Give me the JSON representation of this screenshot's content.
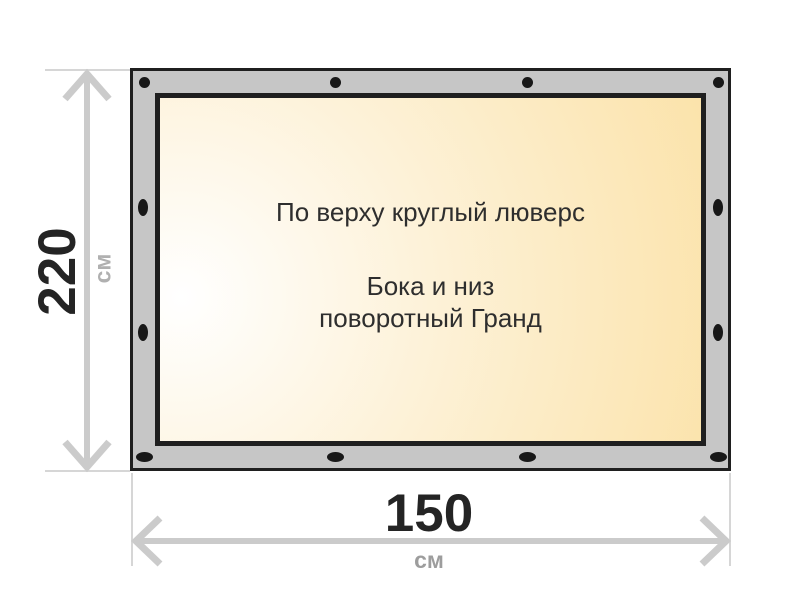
{
  "banner": {
    "top_note": "По верху круглый люверс",
    "sides_note_line1": "Бока и низ",
    "sides_note_line2": "поворотный Гранд",
    "grommet_counts": {
      "top": 4,
      "bottom": 4,
      "left": 2,
      "right": 2
    },
    "icons": {
      "inner": [
        "arrow-up-icon",
        "arrow-down-icon",
        "arrow-left-icon",
        "arrow-right-icon"
      ],
      "dimension": [
        "double-arrow-vertical-icon",
        "double-arrow-horizontal-icon"
      ]
    }
  },
  "dimensions": {
    "height": {
      "value": "220",
      "unit": "см"
    },
    "width": {
      "value": "150",
      "unit": "см"
    }
  },
  "colors": {
    "frame_gray": "#c6c6c6",
    "outline_black": "#1f1f1f",
    "grommet_black": "#181818",
    "canvas_gradient_light": "#ffffff",
    "canvas_gradient_cream": "#fbe2a8",
    "dimension_line_gray": "#cbcbcb",
    "extension_line_gray": "#d6d6d6",
    "value_text_dark": "#242424",
    "unit_text_gray": "#9d9d9d",
    "inner_arrow_tan": "#c7b186",
    "note_text_dark": "#2e2e2e"
  }
}
